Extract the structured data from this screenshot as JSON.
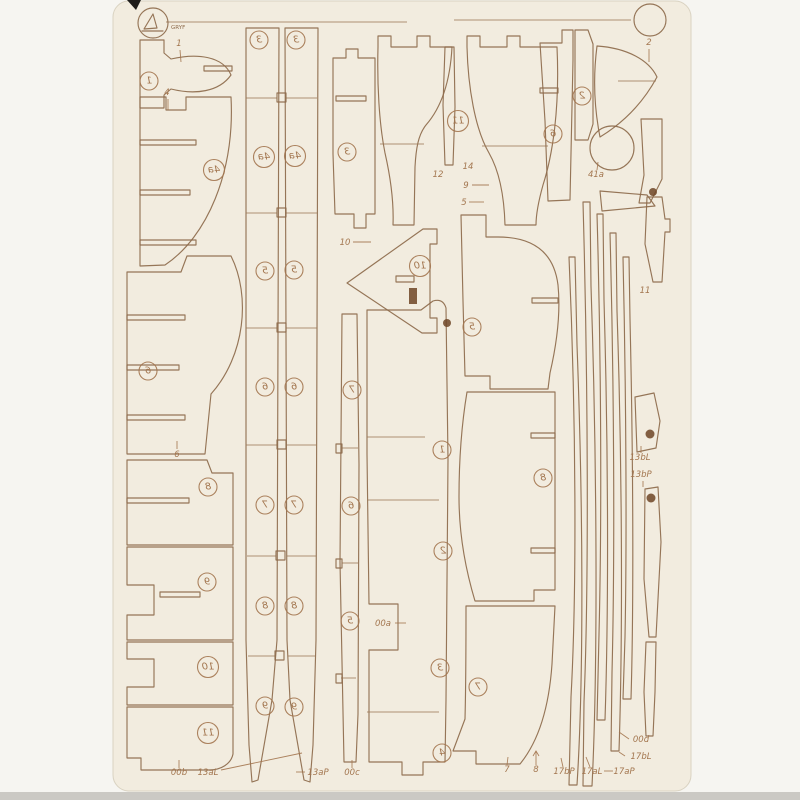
{
  "sheet": {
    "description": "laser-cut wooden model frame sheet scan",
    "colors": {
      "sheet_bg": "#f2ecdf",
      "cut_line": "#8d6a4b",
      "engraving": "#a3764f",
      "scan_bg": "#f6f5f1",
      "bottom_band": "#cbc9c4"
    },
    "logo": {
      "text": "GRYF"
    },
    "circled_labels": [
      {
        "t": "1",
        "x": 149,
        "y": 81
      },
      {
        "t": "4a",
        "x": 214,
        "y": 170
      },
      {
        "t": "6",
        "x": 148,
        "y": 371
      },
      {
        "t": "8",
        "x": 208,
        "y": 487
      },
      {
        "t": "9",
        "x": 207,
        "y": 582
      },
      {
        "t": "10",
        "x": 208,
        "y": 667
      },
      {
        "t": "11",
        "x": 208,
        "y": 733
      },
      {
        "t": "3",
        "x": 259,
        "y": 40
      },
      {
        "t": "3",
        "x": 296,
        "y": 40
      },
      {
        "t": "4a",
        "x": 264,
        "y": 157
      },
      {
        "t": "4a",
        "x": 295,
        "y": 156
      },
      {
        "t": "5",
        "x": 265,
        "y": 271
      },
      {
        "t": "5",
        "x": 294,
        "y": 270
      },
      {
        "t": "6",
        "x": 265,
        "y": 387
      },
      {
        "t": "6",
        "x": 294,
        "y": 387
      },
      {
        "t": "7",
        "x": 265,
        "y": 505
      },
      {
        "t": "7",
        "x": 294,
        "y": 505
      },
      {
        "t": "8",
        "x": 265,
        "y": 606
      },
      {
        "t": "8",
        "x": 294,
        "y": 606
      },
      {
        "t": "9",
        "x": 265,
        "y": 706
      },
      {
        "t": "9",
        "x": 294,
        "y": 707
      },
      {
        "t": "3",
        "x": 347,
        "y": 152
      },
      {
        "t": "11",
        "x": 458,
        "y": 121
      },
      {
        "t": "6",
        "x": 553,
        "y": 134
      },
      {
        "t": "2",
        "x": 582,
        "y": 96
      },
      {
        "t": "10",
        "x": 420,
        "y": 266
      },
      {
        "t": "5",
        "x": 472,
        "y": 327
      },
      {
        "t": "8",
        "x": 543,
        "y": 478
      },
      {
        "t": "7",
        "x": 478,
        "y": 687
      },
      {
        "t": "7",
        "x": 352,
        "y": 390
      },
      {
        "t": "6",
        "x": 351,
        "y": 506
      },
      {
        "t": "5",
        "x": 350,
        "y": 621
      },
      {
        "t": "1",
        "x": 442,
        "y": 450
      },
      {
        "t": "2",
        "x": 443,
        "y": 551
      },
      {
        "t": "3",
        "x": 440,
        "y": 668
      },
      {
        "t": "4",
        "x": 442,
        "y": 753
      }
    ],
    "annotations": [
      {
        "t": "1",
        "x": 179,
        "y": 46,
        "leader": [
          180,
          50,
          181,
          62
        ]
      },
      {
        "t": "4",
        "x": 167,
        "y": 95,
        "leader": [
          168,
          99,
          168,
          110
        ]
      },
      {
        "t": "2",
        "x": 649,
        "y": 45,
        "leader": [
          649,
          49,
          649,
          62
        ]
      },
      {
        "t": "12",
        "x": 438,
        "y": 177
      },
      {
        "t": "14",
        "x": 468,
        "y": 169
      },
      {
        "t": "9",
        "x": 466,
        "y": 188,
        "leader": [
          472,
          185,
          489,
          185
        ]
      },
      {
        "t": "5",
        "x": 464,
        "y": 205,
        "leader": [
          469,
          202,
          484,
          202
        ]
      },
      {
        "t": "10",
        "x": 345,
        "y": 245,
        "leader": [
          353,
          242,
          371,
          242
        ]
      },
      {
        "t": "41a",
        "x": 596,
        "y": 177,
        "leader": [
          597,
          170,
          598,
          162
        ]
      },
      {
        "t": "11",
        "x": 645,
        "y": 293
      },
      {
        "t": "6",
        "x": 177,
        "y": 457,
        "leader": [
          177,
          449,
          177,
          441
        ]
      },
      {
        "t": "00a",
        "x": 383,
        "y": 626,
        "leader": [
          395,
          623,
          406,
          623
        ]
      },
      {
        "t": "13bL",
        "x": 640,
        "y": 460,
        "leader": [
          641,
          453,
          641,
          446
        ]
      },
      {
        "t": "13bP",
        "x": 641,
        "y": 477,
        "leader": [
          643,
          481,
          643,
          487
        ]
      },
      {
        "t": "00b",
        "x": 179,
        "y": 775,
        "leader": [
          179,
          768,
          179,
          760
        ]
      },
      {
        "t": "13aL",
        "x": 208,
        "y": 775,
        "leader": [
          221,
          770,
          302,
          753
        ]
      },
      {
        "t": "13aP",
        "x": 318,
        "y": 775,
        "leader": [
          296,
          772,
          305,
          772
        ]
      },
      {
        "t": "00c",
        "x": 352,
        "y": 775,
        "leader": [
          352,
          768,
          352,
          760
        ]
      },
      {
        "t": "7",
        "x": 507,
        "y": 772,
        "leader": [
          507,
          765,
          508,
          757
        ]
      },
      {
        "t": "8",
        "x": 536,
        "y": 772,
        "leader": [
          536,
          765,
          536,
          751
        ],
        "arrow": true
      },
      {
        "t": "17bP",
        "x": 564,
        "y": 774,
        "leader": [
          563,
          767,
          561,
          758
        ]
      },
      {
        "t": "17aL",
        "x": 592,
        "y": 774,
        "leader": [
          590,
          767,
          586,
          757
        ]
      },
      {
        "t": "17aP",
        "x": 624,
        "y": 774,
        "leader": [
          604,
          771,
          613,
          771
        ]
      },
      {
        "t": "00d",
        "x": 641,
        "y": 742,
        "leader": [
          629,
          739,
          619,
          732
        ]
      },
      {
        "t": "17bL",
        "x": 641,
        "y": 759,
        "leader": [
          625,
          756,
          619,
          752
        ]
      }
    ]
  }
}
